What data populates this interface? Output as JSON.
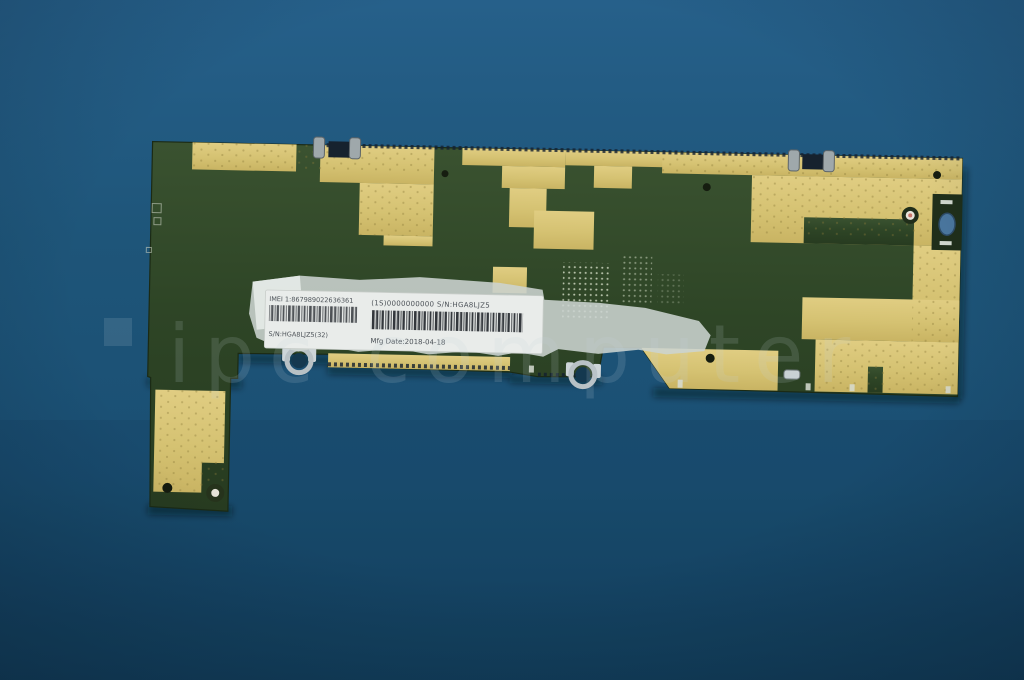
{
  "photo": {
    "description": "green tablet motherboard with gold copper camouflage pattern on blue background"
  },
  "label": {
    "imei_line": "IMEI 1:867989022636361",
    "code_line": "(1S)0000000000  S/N:HGA8LJZ5",
    "serial_line": "S/N:HGA8LJZ5(32)",
    "mfg_line": "Mfg Date:2018-04-18"
  },
  "watermark": {
    "text": "ipc computer"
  },
  "colors": {
    "background_blue": "#1d5478",
    "board_green": "#2e4526",
    "copper_gold": "#d5c272",
    "label_white": "#e9ecea",
    "metal_silver": "#b8c1c5",
    "watermark_gray": "#c6d4dc"
  }
}
